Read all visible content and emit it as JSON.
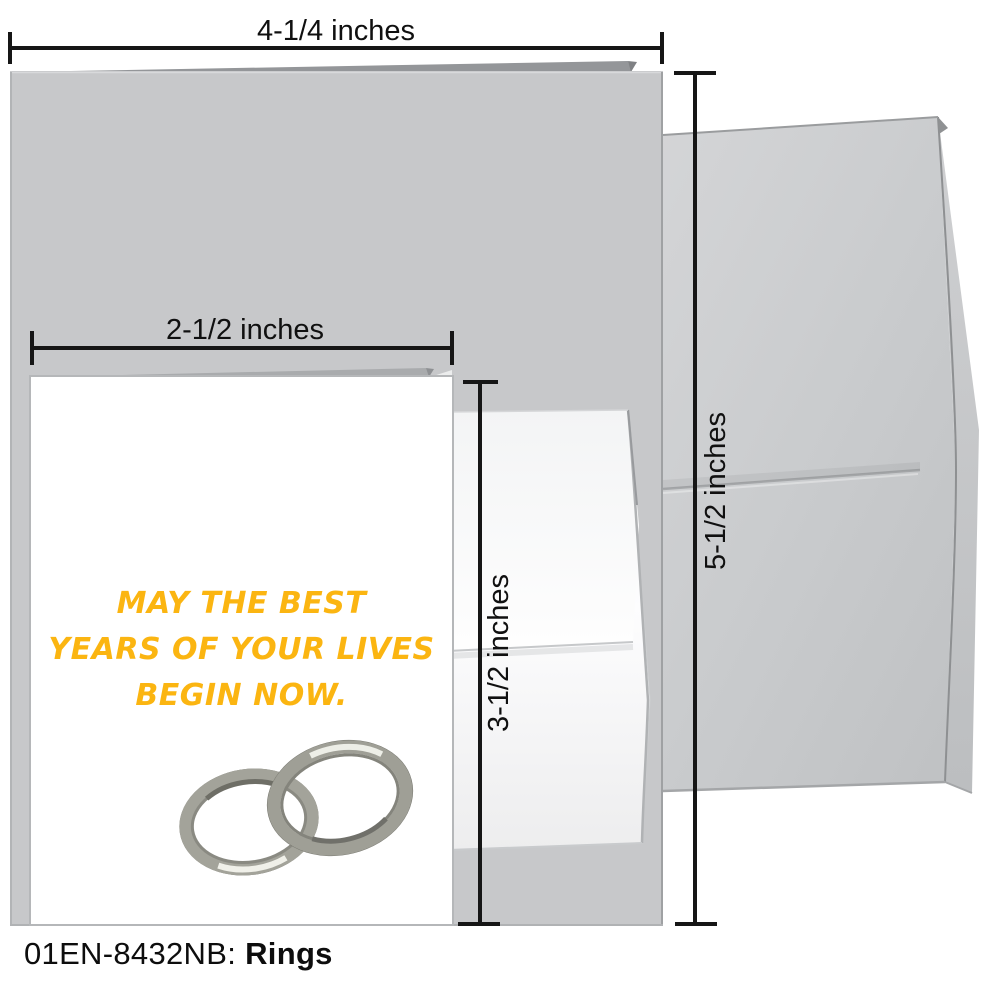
{
  "product": {
    "code": "01EN-8432NB:",
    "name": "Rings"
  },
  "dimension_labels": {
    "large_card_width": "4-1/4 inches",
    "large_card_height": "5-1/2 inches",
    "small_card_width": "2-1/2 inches",
    "small_card_height": "3-1/2 inches"
  },
  "card": {
    "message_lines": [
      "MAY THE BEST",
      "YEARS OF YOUR LIVES",
      "BEGIN NOW."
    ],
    "artwork": "two-silver-wedding-rings-watercolor"
  },
  "colors": {
    "message_yellow": "#FBB511",
    "large_card_gray": "#C7C8CA",
    "envelope_gray": "#CDCFD1",
    "small_envelope_white": "#F7F8F9",
    "dimension_line": "#161616"
  }
}
